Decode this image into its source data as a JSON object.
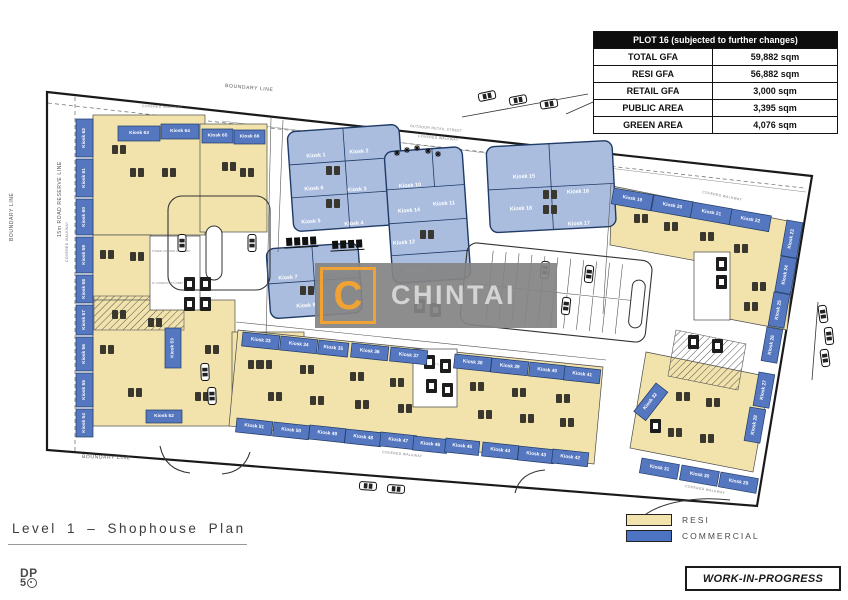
{
  "table": {
    "title": "PLOT 16 (subjected to further changes)",
    "rows": [
      {
        "label": "TOTAL GFA",
        "value": "59,882 sqm"
      },
      {
        "label": "RESI GFA",
        "value": "56,882 sqm"
      },
      {
        "label": "RETAIL GFA",
        "value": "3,000 sqm"
      },
      {
        "label": "PUBLIC AREA",
        "value": "3,395 sqm"
      },
      {
        "label": "GREEN AREA",
        "value": "4,076 sqm"
      }
    ]
  },
  "legend": {
    "items": [
      {
        "label": "RESI",
        "color": "#f2e3ac"
      },
      {
        "label": "COMMERCIAL",
        "color": "#4d74c4"
      }
    ]
  },
  "title_block": {
    "title": "Level 1 – Shophouse Plan"
  },
  "dp_logo": {
    "top": "DP",
    "bottom_number": "5"
  },
  "stamp": {
    "label": "WORK-IN-PROGRESS"
  },
  "watermark": {
    "letter": "C",
    "name": "CHINTAI",
    "accent": "#f0a235"
  },
  "plan": {
    "colors": {
      "resi": "#f2e3ac",
      "commercial_strip": "#5577c0",
      "commercial_block": "#aabdde",
      "block_border": "#1f3a66"
    },
    "labels": {
      "boundary": "BOUNDARY LINE",
      "road_reserve": "15m ROAD RESERVE LINE",
      "outdoor_retail_street": "OUTDOOR RETAIL STREET",
      "covered_walkway": "COVERED WALKWAY",
      "lift_lobby_private": "TOWER 1 PRIVATE LIFT LOBBY",
      "lift_lobby_common": "1F COMMON LIFT LOBBY"
    },
    "kiosks": [
      {
        "label": "Kiosk 1",
        "x": 316,
        "y": 156,
        "kind": "zone",
        "r": -4
      },
      {
        "label": "Kiosk 2",
        "x": 359,
        "y": 152,
        "kind": "zone",
        "r": -4
      },
      {
        "label": "Kiosk 3",
        "x": 357,
        "y": 190,
        "kind": "zone",
        "r": -4
      },
      {
        "label": "Kiosk 4",
        "x": 354,
        "y": 224,
        "kind": "zone",
        "r": -4
      },
      {
        "label": "Kiosk 5",
        "x": 311,
        "y": 222,
        "kind": "zone",
        "r": -4
      },
      {
        "label": "Kiosk 6",
        "x": 314,
        "y": 189,
        "kind": "zone",
        "r": -4
      },
      {
        "label": "Kiosk 7",
        "x": 288,
        "y": 278,
        "kind": "zone",
        "r": -4
      },
      {
        "label": "Kiosk 8",
        "x": 330,
        "y": 272,
        "kind": "zone",
        "r": -4
      },
      {
        "label": "Kiosk 9",
        "x": 306,
        "y": 306,
        "kind": "zone",
        "r": -4
      },
      {
        "label": "Kiosk 10",
        "x": 410,
        "y": 186,
        "kind": "zone",
        "r": -4
      },
      {
        "label": "Kiosk 11",
        "x": 444,
        "y": 204,
        "kind": "zone",
        "r": -4
      },
      {
        "label": "Kiosk 14",
        "x": 409,
        "y": 211,
        "kind": "zone",
        "r": -4
      },
      {
        "label": "Kiosk 12",
        "x": 404,
        "y": 243,
        "kind": "zone",
        "r": -4
      },
      {
        "label": "Kiosk 13",
        "x": 416,
        "y": 271,
        "kind": "zone",
        "r": -4
      },
      {
        "label": "Kiosk 15",
        "x": 524,
        "y": 177,
        "kind": "zone",
        "r": -3
      },
      {
        "label": "Kiosk 16",
        "x": 578,
        "y": 192,
        "kind": "zone",
        "r": -3
      },
      {
        "label": "Kiosk 18",
        "x": 521,
        "y": 209,
        "kind": "zone",
        "r": -3
      },
      {
        "label": "Kiosk 17",
        "x": 579,
        "y": 224,
        "kind": "zone",
        "r": -3
      },
      {
        "label": "Kiosk 63",
        "x": 118,
        "y": 126,
        "w": 42,
        "h": 15,
        "kind": "strip"
      },
      {
        "label": "Kiosk 64",
        "x": 161,
        "y": 124,
        "w": 38,
        "h": 15,
        "kind": "strip"
      },
      {
        "label": "Kiosk 65",
        "x": 202,
        "y": 129,
        "w": 31,
        "h": 14,
        "kind": "strip"
      },
      {
        "label": "Kiosk 66",
        "x": 234,
        "y": 130,
        "w": 31,
        "h": 14,
        "kind": "strip"
      },
      {
        "label": "Kiosk 62",
        "x": 76,
        "y": 119,
        "w": 17,
        "h": 38,
        "kind": "strip",
        "vert": true
      },
      {
        "label": "Kiosk 61",
        "x": 76,
        "y": 159,
        "w": 17,
        "h": 38,
        "kind": "strip",
        "vert": true
      },
      {
        "label": "Kiosk 60",
        "x": 76,
        "y": 199,
        "w": 17,
        "h": 36,
        "kind": "strip",
        "vert": true
      },
      {
        "label": "Kiosk 59",
        "x": 76,
        "y": 237,
        "w": 17,
        "h": 36,
        "kind": "strip",
        "vert": true
      },
      {
        "label": "Kiosk 58",
        "x": 76,
        "y": 275,
        "w": 17,
        "h": 28,
        "kind": "strip",
        "vert": true
      },
      {
        "label": "Kiosk 57",
        "x": 76,
        "y": 305,
        "w": 17,
        "h": 30,
        "kind": "strip",
        "vert": true
      },
      {
        "label": "Kiosk 56",
        "x": 76,
        "y": 337,
        "w": 17,
        "h": 34,
        "kind": "strip",
        "vert": true
      },
      {
        "label": "Kiosk 55",
        "x": 76,
        "y": 373,
        "w": 17,
        "h": 34,
        "kind": "strip",
        "vert": true
      },
      {
        "label": "Kiosk 54",
        "x": 76,
        "y": 409,
        "w": 17,
        "h": 28,
        "kind": "strip",
        "vert": true
      },
      {
        "label": "Kiosk 53",
        "x": 165,
        "y": 328,
        "w": 16,
        "h": 40,
        "kind": "strip",
        "vert": true
      },
      {
        "label": "Kiosk 52",
        "x": 146,
        "y": 410,
        "w": 36,
        "h": 13,
        "kind": "strip"
      },
      {
        "label": "Kiosk 19",
        "x": 614,
        "y": 188,
        "w": 40,
        "h": 16,
        "kind": "strip",
        "r": 10
      },
      {
        "label": "Kiosk 20",
        "x": 654,
        "y": 195,
        "w": 40,
        "h": 16,
        "kind": "strip",
        "r": 10
      },
      {
        "label": "Kiosk 21",
        "x": 693,
        "y": 202,
        "w": 40,
        "h": 16,
        "kind": "strip",
        "r": 10
      },
      {
        "label": "Kiosk 22",
        "x": 732,
        "y": 209,
        "w": 40,
        "h": 16,
        "kind": "strip",
        "r": 10
      },
      {
        "label": "Kiosk 23",
        "x": 787,
        "y": 220,
        "w": 16,
        "h": 36,
        "kind": "strip",
        "r": 10,
        "vert": true
      },
      {
        "label": "Kiosk 24",
        "x": 781,
        "y": 256,
        "w": 16,
        "h": 36,
        "kind": "strip",
        "r": 10,
        "vert": true
      },
      {
        "label": "Kiosk 25",
        "x": 774,
        "y": 292,
        "w": 16,
        "h": 34,
        "kind": "strip",
        "r": 10,
        "vert": true
      },
      {
        "label": "Kiosk 26",
        "x": 767,
        "y": 327,
        "w": 16,
        "h": 34,
        "kind": "strip",
        "r": 10,
        "vert": true
      },
      {
        "label": "Kiosk 27",
        "x": 759,
        "y": 372,
        "w": 16,
        "h": 34,
        "kind": "strip",
        "r": 10,
        "vert": true
      },
      {
        "label": "Kiosk 28",
        "x": 750,
        "y": 407,
        "w": 16,
        "h": 34,
        "kind": "strip",
        "r": 10,
        "vert": true
      },
      {
        "label": "Kiosk 32",
        "x": 656,
        "y": 383,
        "w": 15,
        "h": 36,
        "kind": "strip",
        "r": 38,
        "vert": true
      },
      {
        "label": "Kiosk 31",
        "x": 642,
        "y": 458,
        "w": 38,
        "h": 15,
        "kind": "strip",
        "r": 10
      },
      {
        "label": "Kiosk 30",
        "x": 682,
        "y": 465,
        "w": 38,
        "h": 15,
        "kind": "strip",
        "r": 10
      },
      {
        "label": "Kiosk 29",
        "x": 721,
        "y": 472,
        "w": 38,
        "h": 15,
        "kind": "strip",
        "r": 10
      },
      {
        "label": "Kiosk 33",
        "x": 243,
        "y": 332,
        "w": 37,
        "h": 14,
        "kind": "strip",
        "r": 6
      },
      {
        "label": "Kiosk 34",
        "x": 281,
        "y": 336,
        "w": 37,
        "h": 14,
        "kind": "strip",
        "r": 6
      },
      {
        "label": "Kiosk 35",
        "x": 319,
        "y": 340,
        "w": 30,
        "h": 14,
        "kind": "strip",
        "r": 6
      },
      {
        "label": "Kiosk 36",
        "x": 352,
        "y": 343,
        "w": 37,
        "h": 14,
        "kind": "strip",
        "r": 6
      },
      {
        "label": "Kiosk 37",
        "x": 391,
        "y": 347,
        "w": 37,
        "h": 14,
        "kind": "strip",
        "r": 6
      },
      {
        "label": "Kiosk 38",
        "x": 455,
        "y": 354,
        "w": 37,
        "h": 14,
        "kind": "strip",
        "r": 6
      },
      {
        "label": "Kiosk 39",
        "x": 492,
        "y": 358,
        "w": 37,
        "h": 14,
        "kind": "strip",
        "r": 6
      },
      {
        "label": "Kiosk 40",
        "x": 530,
        "y": 362,
        "w": 36,
        "h": 14,
        "kind": "strip",
        "r": 6
      },
      {
        "label": "Kiosk 41",
        "x": 565,
        "y": 366,
        "w": 36,
        "h": 14,
        "kind": "strip",
        "r": 6
      },
      {
        "label": "Kiosk 51",
        "x": 237,
        "y": 418,
        "w": 36,
        "h": 14,
        "kind": "strip",
        "r": 6
      },
      {
        "label": "Kiosk 50",
        "x": 274,
        "y": 422,
        "w": 36,
        "h": 14,
        "kind": "strip",
        "r": 6
      },
      {
        "label": "Kiosk 49",
        "x": 310,
        "y": 425,
        "w": 36,
        "h": 14,
        "kind": "strip",
        "r": 6
      },
      {
        "label": "Kiosk 48",
        "x": 346,
        "y": 429,
        "w": 36,
        "h": 14,
        "kind": "strip",
        "r": 6
      },
      {
        "label": "Kiosk 47",
        "x": 381,
        "y": 432,
        "w": 36,
        "h": 14,
        "kind": "strip",
        "r": 6
      },
      {
        "label": "Kiosk 46",
        "x": 414,
        "y": 436,
        "w": 34,
        "h": 14,
        "kind": "strip",
        "r": 6
      },
      {
        "label": "Kiosk 45",
        "x": 446,
        "y": 438,
        "w": 34,
        "h": 14,
        "kind": "strip",
        "r": 6
      },
      {
        "label": "Kiosk 44",
        "x": 483,
        "y": 442,
        "w": 36,
        "h": 14,
        "kind": "strip",
        "r": 6
      },
      {
        "label": "Kiosk 43",
        "x": 519,
        "y": 446,
        "w": 36,
        "h": 14,
        "kind": "strip",
        "r": 6
      },
      {
        "label": "Kiosk 42",
        "x": 553,
        "y": 449,
        "w": 36,
        "h": 14,
        "kind": "strip",
        "r": 6
      }
    ],
    "cars": [
      [
        487,
        96,
        -12
      ],
      [
        518,
        100,
        -11
      ],
      [
        549,
        104,
        -9
      ],
      [
        823,
        314,
        82
      ],
      [
        829,
        336,
        84
      ],
      [
        825,
        358,
        82
      ],
      [
        368,
        486,
        4
      ],
      [
        396,
        489,
        4
      ],
      [
        205,
        372,
        88
      ],
      [
        212,
        396,
        88
      ],
      [
        545,
        270,
        96
      ],
      [
        589,
        274,
        96
      ],
      [
        566,
        306,
        96
      ],
      [
        182,
        243,
        90
      ],
      [
        252,
        243,
        90
      ]
    ],
    "trees": [
      [
        397,
        153
      ],
      [
        407,
        150
      ],
      [
        417,
        148
      ],
      [
        428,
        151
      ],
      [
        438,
        154
      ]
    ],
    "cores": [
      [
        184,
        277
      ],
      [
        200,
        277
      ],
      [
        184,
        297
      ],
      [
        200,
        297
      ],
      [
        424,
        355
      ],
      [
        440,
        359
      ],
      [
        426,
        379
      ],
      [
        442,
        383
      ],
      [
        716,
        257
      ],
      [
        716,
        275
      ],
      [
        688,
        335
      ],
      [
        712,
        339
      ],
      [
        650,
        419
      ],
      [
        414,
        299
      ],
      [
        430,
        303
      ]
    ],
    "furniture": [
      [
        112,
        145
      ],
      [
        130,
        168
      ],
      [
        162,
        168
      ],
      [
        222,
        162
      ],
      [
        240,
        168
      ],
      [
        100,
        250
      ],
      [
        130,
        252
      ],
      [
        112,
        310
      ],
      [
        100,
        345
      ],
      [
        128,
        388
      ],
      [
        148,
        318
      ],
      [
        205,
        345
      ],
      [
        248,
        360
      ],
      [
        195,
        392
      ],
      [
        634,
        214
      ],
      [
        664,
        222
      ],
      [
        700,
        232
      ],
      [
        734,
        244
      ],
      [
        752,
        282
      ],
      [
        744,
        302
      ],
      [
        676,
        392
      ],
      [
        706,
        398
      ],
      [
        668,
        428
      ],
      [
        700,
        434
      ],
      [
        258,
        360
      ],
      [
        300,
        365
      ],
      [
        268,
        392
      ],
      [
        310,
        396
      ],
      [
        350,
        372
      ],
      [
        390,
        378
      ],
      [
        355,
        400
      ],
      [
        398,
        404
      ],
      [
        470,
        382
      ],
      [
        512,
        388
      ],
      [
        478,
        410
      ],
      [
        520,
        414
      ],
      [
        556,
        394
      ],
      [
        560,
        418
      ],
      [
        326,
        166
      ],
      [
        326,
        199
      ],
      [
        543,
        190
      ],
      [
        543,
        205
      ],
      [
        300,
        286
      ],
      [
        420,
        230
      ]
    ]
  }
}
